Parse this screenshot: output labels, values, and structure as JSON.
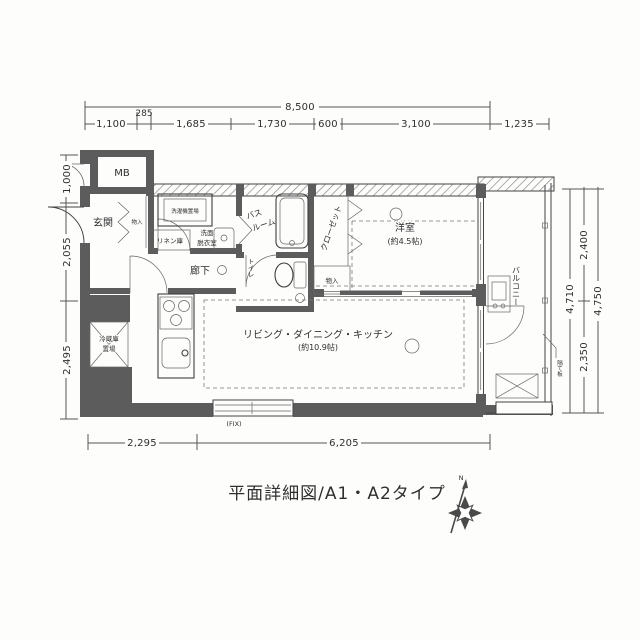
{
  "title": "平面詳細図/A1・A2タイプ",
  "compass": {
    "north": "N"
  },
  "dims": {
    "top_total": "8,500",
    "top": [
      "1,100",
      "285",
      "1,685",
      "1,730",
      "600",
      "3,100",
      "1,235"
    ],
    "left": [
      "1,000",
      "2,055",
      "2,495"
    ],
    "right": {
      "inner_total": "4,710",
      "upper": "2,400",
      "lower": "2,350",
      "outer_total": "4,750"
    },
    "bottom": [
      "2,295",
      "6,205"
    ],
    "fix_label": "(FIX)"
  },
  "rooms": {
    "mb": "MB",
    "entrance": "玄関",
    "storage_entrance": "物入",
    "laundry": "洗濯機置場",
    "linen": "リネン庫",
    "washroom_l1": "洗面",
    "washroom_l2": "脱衣室",
    "bath_l1": "バス",
    "bath_l2": "ルーム",
    "hallway": "廊下",
    "toilet": "トイレ",
    "closet": "クローゼット",
    "storage_bedroom": "物入",
    "bedroom_l1": "洋室",
    "bedroom_l2": "(約4.5帖)",
    "ldk_l1": "リビング・ダイニング・キッチン",
    "ldk_l2": "(約10.9帖)",
    "fridge_l1": "冷蔵庫",
    "fridge_l2": "置場",
    "balcony": "バルコニー",
    "partition": "隔て板"
  }
}
